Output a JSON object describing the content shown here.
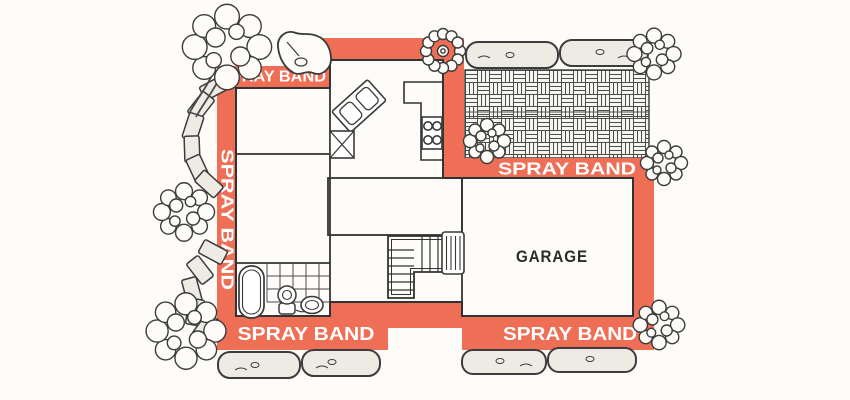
{
  "diagram": {
    "type": "house-floor-plan-with-perimeter-spray-band",
    "spray_band_labels": {
      "top_left": "SPRAY BAND",
      "left": "SPRAY BAND",
      "right": "SPRAY BAND",
      "bottom_left": "SPRAY BAND",
      "bottom_right": "SPRAY BAND"
    },
    "room_labels": {
      "garage": "GARAGE"
    },
    "colors": {
      "spray_band": "#ef6e56",
      "band_text": "#ffffff",
      "wall_line": "#333333",
      "room_fill": "#ffffff",
      "stone_fill": "#edebe4",
      "background": "#fdfcf9"
    }
  }
}
